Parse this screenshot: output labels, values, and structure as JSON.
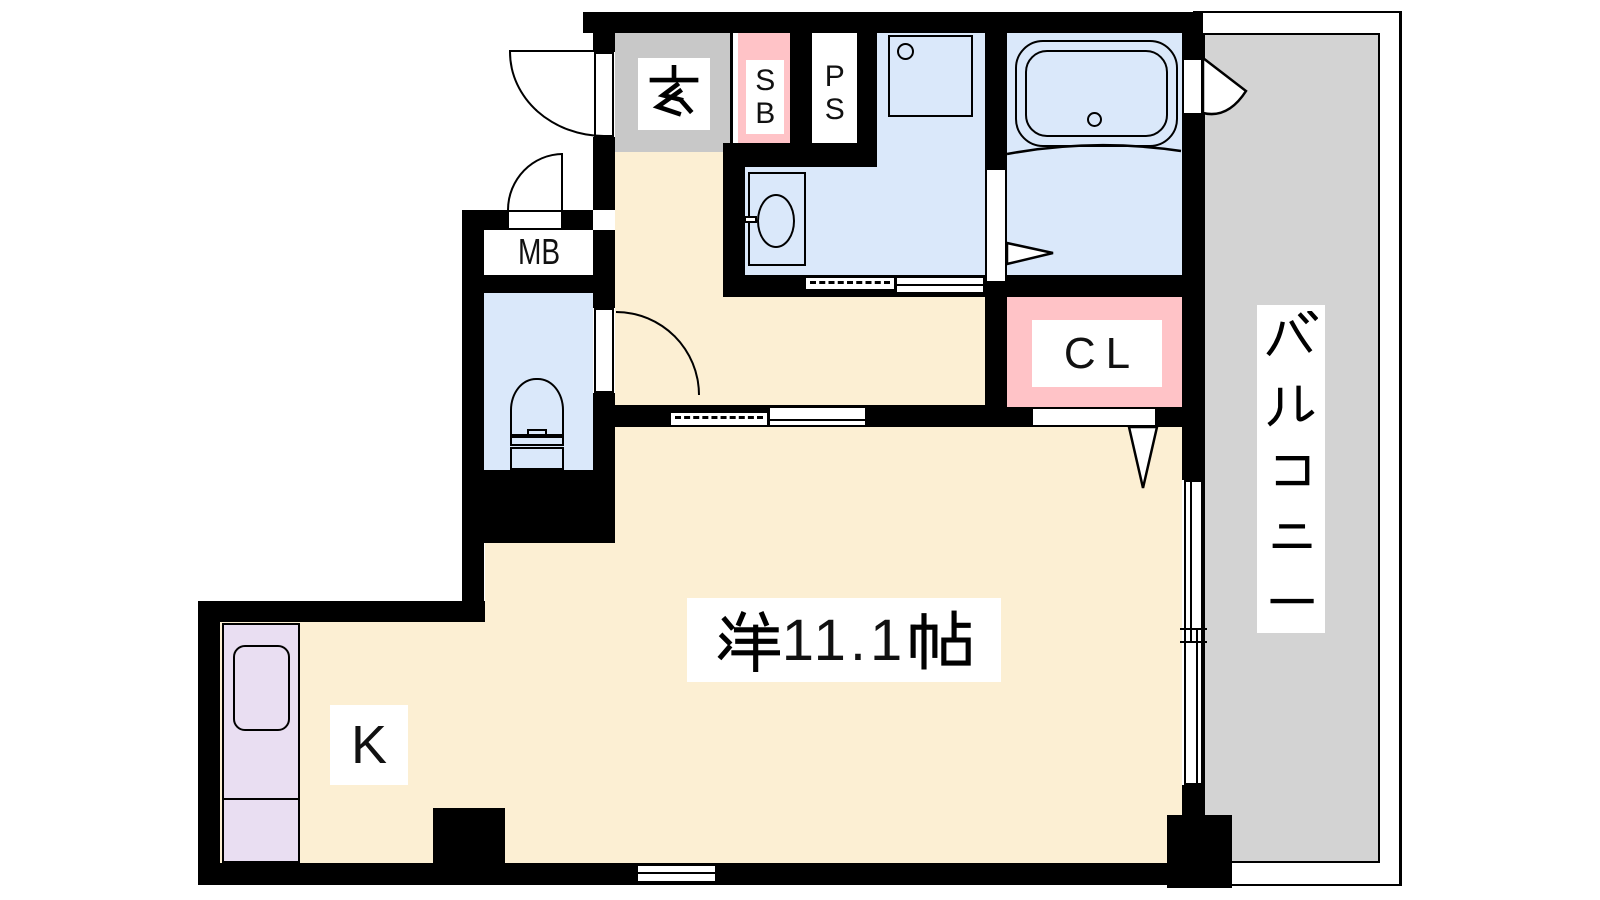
{
  "document": {
    "type": "apartment-floor-plan"
  },
  "rooms": {
    "genkan": {
      "label": "玄",
      "color": "#C8C8C8"
    },
    "shoe_box": {
      "label": "SB",
      "color": "#FFC3C7"
    },
    "pipe_space": {
      "label": "PS",
      "color": "#FFFFFF"
    },
    "meter_box": {
      "label": "MB",
      "color": "#FFFFFF"
    },
    "closet": {
      "label": "CL",
      "color": "#FFC3C7"
    },
    "kitchen": {
      "label": "K",
      "color": "#E9DEF2"
    },
    "western_room": {
      "label": "洋11.1帖",
      "area_text": "11.1",
      "color": "#FCEFD3"
    },
    "balcony": {
      "label": "バルコニー",
      "color": "#D3D3D3"
    },
    "washroom": {
      "color": "#DAE8FA"
    },
    "bathroom": {
      "color": "#DAE8FA"
    },
    "toilet_room": {
      "color": "#DAE8FA"
    }
  },
  "fixtures": [
    "bathtub",
    "bathtub-drain",
    "washbasin",
    "washbasin-tap",
    "washing-machine-pan",
    "toilet-bowl",
    "toilet-tank",
    "kitchen-sink",
    "entrance-door",
    "meter-box-door",
    "toilet-door",
    "bathroom-folding-door",
    "balcony-door",
    "closet-door",
    "hall-sliding-door",
    "washroom-sliding-door",
    "balcony-sliding-window",
    "small-window"
  ],
  "colors": {
    "wall": "#000000",
    "floor_cream": "#FCEFD3",
    "wet_area_blue": "#DAE8FA",
    "accent_pink": "#FFC3C7",
    "kitchen_purple": "#E9DEF2",
    "genkan_gray": "#C8C8C8",
    "balcony_gray": "#D3D3D3"
  }
}
